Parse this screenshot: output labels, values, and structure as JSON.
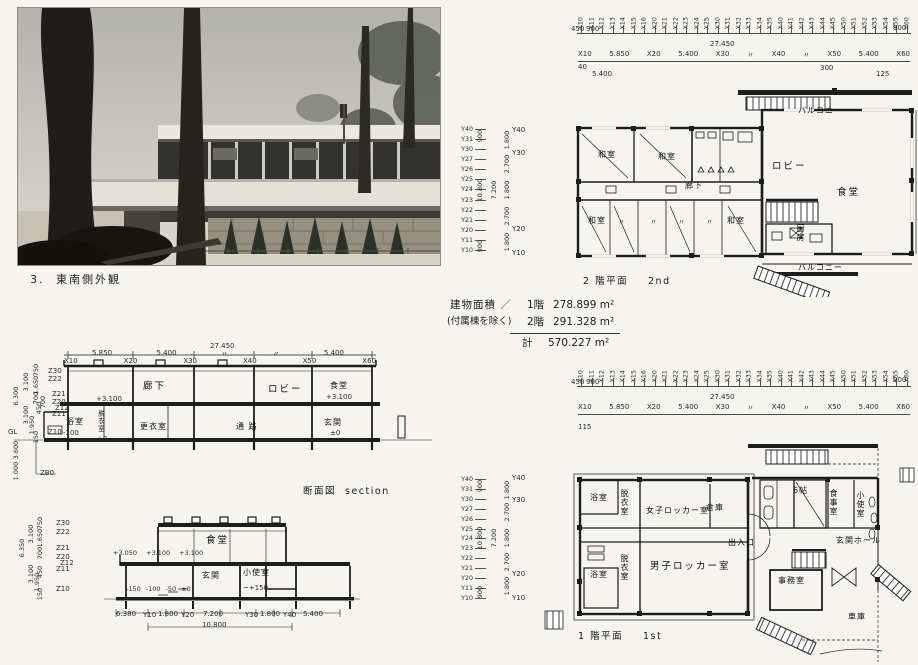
{
  "page": {
    "bg": "#f6f4ee",
    "ink": "#1d1d1b"
  },
  "photo": {
    "caption_no": "3.",
    "caption": "東南側外観"
  },
  "grid": {
    "x_minor": [
      "X10",
      "X11",
      "X12",
      "X13",
      "X14",
      "X15",
      "X16",
      "X20",
      "X21",
      "X22",
      "X23",
      "X24",
      "X25",
      "X30",
      "X31",
      "X32",
      "X33",
      "X34",
      "X35",
      "X40",
      "X41",
      "X42",
      "X43",
      "X44",
      "X45",
      "X50",
      "X51",
      "X52",
      "X53",
      "X54",
      "X55",
      "X60"
    ],
    "x_major_row": [
      "X10",
      "5.850",
      "X20",
      "5.400",
      "X30",
      "〃",
      "X40",
      "〃",
      "X50",
      "5.400",
      "X60"
    ],
    "d450": "450",
    "d900": "900",
    "d27450": "27.450",
    "y_minor": [
      "Y40",
      "Y31",
      "Y30",
      "Y27",
      "Y26",
      "Y25",
      "Y24",
      "Y23",
      "Y22",
      "Y21",
      "Y20",
      "Y11",
      "Y10"
    ],
    "y_major": [
      "Y40",
      "Y30",
      "Y20",
      "Y10"
    ],
    "y_outer_top": "900",
    "y_overall": "10.800",
    "y_outer_bottom": "900",
    "y_mid": "7.200",
    "y_inner": [
      "1.800",
      "2.700",
      "1.800",
      "2.700",
      "1.800"
    ]
  },
  "plan2": {
    "title_jp": "2 階平面",
    "title_en": "2nd",
    "d40": "40",
    "d5400": "5.400",
    "d300": "300",
    "d125": "125",
    "ditto": "〃",
    "rooms": {
      "washitsu_a": "和室",
      "washitsu_b": "和室",
      "rouka": "廊下",
      "washitsu_c": "和室",
      "washitsu_d": "和室",
      "lobby": "ロビー",
      "dining": "食堂",
      "kitchen": "厨房",
      "balcony_top": "バルコニー",
      "balcony_bottom": "バルコニー"
    }
  },
  "plan1": {
    "title_jp": "1 階平面",
    "title_en": "1st",
    "d115": "115",
    "rooms": {
      "bath_a": "浴室",
      "datsui_a": "脱衣室",
      "women_locker": "女子ロッカー室",
      "storage": "倉庫",
      "six_mat": "6帖",
      "dining": "食事室",
      "kozukai": "小使室",
      "entrance": "出入口",
      "hall": "玄関ホール",
      "bath_b": "浴室",
      "datsui_b": "脱衣室",
      "men_locker": "男子ロッカー室",
      "office": "事務室",
      "garage": "車庫"
    }
  },
  "area": {
    "label": "建物面積 ／",
    "note": "(付属棟を除く)",
    "f1": "1階",
    "f1v": "278.899 m²",
    "f2": "2階",
    "f2v": "291.328 m²",
    "total_label": "計",
    "total": "570.227 m²"
  },
  "section1": {
    "caption_jp": "断面図",
    "caption_en": "section",
    "d27450": "27.450",
    "dims_row": [
      "5.850",
      "5.400",
      "〃",
      "〃",
      "5.400"
    ],
    "x_row": [
      "X10",
      "X20",
      "X30",
      "X40",
      "X50",
      "X60"
    ],
    "z": [
      "Z30",
      "Z22",
      "Z21",
      "Z20",
      "Z12",
      "Z11",
      "Z10"
    ],
    "gl": "GL",
    "zb0": "ZB0",
    "zd": {
      "h6300": "6.300",
      "h3600": "3.600",
      "h1000": "1.000",
      "h3100a": "3.100",
      "h3100b": "3.100",
      "h1950": "1.950",
      "h150": "150",
      "h750": "750",
      "h1650": "1.650",
      "h700a": "700",
      "h450": "450",
      "h700b": "700"
    },
    "rooms": {
      "rouka": "廊下",
      "rouka_lv": "+3.100",
      "lobby": "ロビー",
      "dining": "食堂",
      "dining_lv": "+3.100",
      "bath": "浴室",
      "bath_lv": "-100",
      "datsui": "脱衣室",
      "datsui_lv": "±0",
      "koui": "更衣室",
      "tsuro": "通  路",
      "genkan": "玄関",
      "genkan_lv": "±0"
    }
  },
  "section2": {
    "z": [
      "Z30",
      "Z22",
      "Z21",
      "Z20",
      "Z12",
      "Z11",
      "Z10"
    ],
    "zd": {
      "h6350": "6.350",
      "h3100a": "3.100",
      "h3100b": "3.100",
      "h1950": "1.950",
      "h150": "150",
      "h750": "750",
      "h1650": "1.650",
      "h700": "700",
      "h450": "450"
    },
    "rooms": {
      "dining": "食堂",
      "genkan": "玄関",
      "kozukai": "小使室",
      "kozukai_lv": "~+150"
    },
    "upper_levels": [
      "+3.050",
      "+3.100",
      "+3.100"
    ],
    "lower_levels": [
      "-150",
      "-100",
      "-50",
      "±0"
    ],
    "bottom_row": [
      "6.380",
      "Y10",
      "1.800",
      "Y20",
      "7.200",
      "Y30",
      "1.800",
      "Y40",
      "5.400"
    ],
    "d10800": "10.800"
  }
}
